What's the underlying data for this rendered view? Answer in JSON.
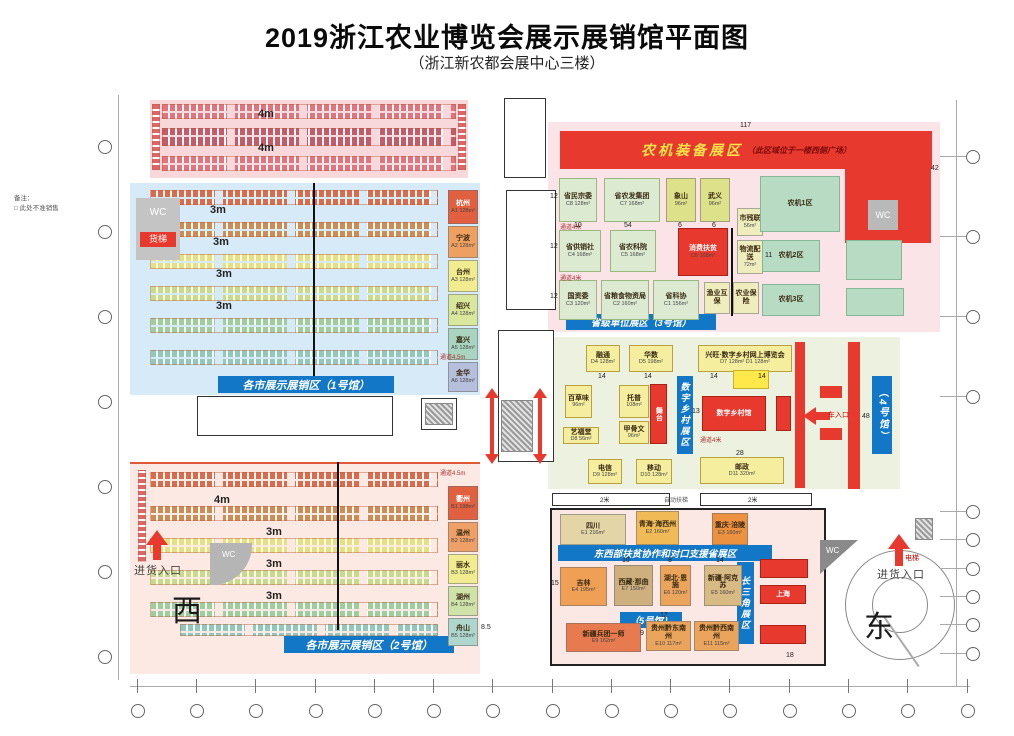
{
  "title": "2019浙江农业博览会展示展销馆平面图",
  "subtitle": "（浙江新农都会展中心三楼）",
  "legend": {
    "label": "备注：",
    "text": "□ 此处不准销售"
  },
  "compass": {
    "west": "西",
    "east": "东"
  },
  "entrances": {
    "west": "进货入口",
    "east": "进货入口",
    "vehicle": "车入口",
    "elevator": "电梯"
  },
  "facilities": {
    "wc": "WC",
    "freight_elevator": "货梯"
  },
  "banners": {
    "hall1": "各市展示展销区（1号馆）",
    "hall2": "各市展示展销区（2号馆）",
    "hall3": "省级单位展区（3号馆）",
    "hall4": "（4号馆）",
    "hall5": "（5号馆）",
    "east_west": "东西部扶贫协作和对口支援省展区",
    "digital": "数字乡村展区",
    "delta": "长三角展区",
    "machinery": "农机装备展区",
    "machinery_note": "（此区域位于一楼西侧广场）"
  },
  "blocks": [
    {
      "name": "杭州",
      "code": "A1 128m²",
      "style": {
        "left": "448px",
        "top": "190px",
        "width": "30px",
        "height": "34px",
        "background": "#e0603f",
        "color": "#fff"
      }
    },
    {
      "name": "宁波",
      "code": "A2 128m²",
      "style": {
        "left": "448px",
        "top": "226px",
        "width": "30px",
        "height": "32px",
        "background": "#eda05f"
      }
    },
    {
      "name": "台州",
      "code": "A3 128m²",
      "style": {
        "left": "448px",
        "top": "260px",
        "width": "30px",
        "height": "32px",
        "background": "#f0ec8f"
      }
    },
    {
      "name": "绍兴",
      "code": "A4 128m²",
      "style": {
        "left": "448px",
        "top": "294px",
        "width": "30px",
        "height": "32px",
        "background": "#d9e79c"
      }
    },
    {
      "name": "嘉兴",
      "code": "A5 128m²",
      "style": {
        "left": "448px",
        "top": "328px",
        "width": "30px",
        "height": "32px",
        "background": "#a8d4c0"
      }
    },
    {
      "name": "金华",
      "code": "A6 128m²",
      "style": {
        "left": "448px",
        "top": "362px",
        "width": "30px",
        "height": "30px",
        "background": "#b6bfdb"
      }
    },
    {
      "name": "衢州",
      "code": "B1 198m²",
      "style": {
        "left": "448px",
        "top": "486px",
        "width": "30px",
        "height": "34px",
        "background": "#e0603f",
        "color": "#fff"
      }
    },
    {
      "name": "温州",
      "code": "B2 128m²",
      "style": {
        "left": "448px",
        "top": "522px",
        "width": "30px",
        "height": "30px",
        "background": "#efa066"
      }
    },
    {
      "name": "丽水",
      "code": "B3 128m²",
      "style": {
        "left": "448px",
        "top": "554px",
        "width": "30px",
        "height": "30px",
        "background": "#f0ec8f"
      }
    },
    {
      "name": "湖州",
      "code": "B4 128m²",
      "style": {
        "left": "448px",
        "top": "586px",
        "width": "30px",
        "height": "30px",
        "background": "#cfe3a8"
      }
    },
    {
      "name": "舟山",
      "code": "B5 128m²",
      "style": {
        "left": "448px",
        "top": "618px",
        "width": "30px",
        "height": "28px",
        "background": "#aed6cd"
      }
    },
    {
      "name": "省民宗委",
      "code": "C8 128m²",
      "style": {
        "left": "559px",
        "top": "178px",
        "width": "38px",
        "height": "44px",
        "background": "#dcead2",
        "borderColor": "#9ab87e"
      }
    },
    {
      "name": "省农发集团",
      "code": "C7 168m²",
      "style": {
        "left": "604px",
        "top": "178px",
        "width": "56px",
        "height": "44px",
        "background": "#dcead2",
        "borderColor": "#9ab87e"
      }
    },
    {
      "name": "象山",
      "code": "96m²",
      "style": {
        "left": "666px",
        "top": "178px",
        "width": "30px",
        "height": "44px",
        "background": "#dde28a"
      }
    },
    {
      "name": "武义",
      "code": "96m²",
      "style": {
        "left": "700px",
        "top": "178px",
        "width": "30px",
        "height": "44px",
        "background": "#dde28a"
      }
    },
    {
      "name": "省供销社",
      "code": "C4 168m²",
      "style": {
        "left": "559px",
        "top": "230px",
        "width": "42px",
        "height": "42px",
        "background": "#dcead2",
        "borderColor": "#9ab87e"
      }
    },
    {
      "name": "省农科院",
      "code": "C5 168m²",
      "style": {
        "left": "610px",
        "top": "230px",
        "width": "46px",
        "height": "42px",
        "background": "#dcead2",
        "borderColor": "#9ab87e"
      }
    },
    {
      "name": "消费扶贫",
      "code": "C6 168m²",
      "style": {
        "left": "678px",
        "top": "228px",
        "width": "50px",
        "height": "48px",
        "background": "#e8392e",
        "color": "#fff",
        "borderColor": "#a82218"
      }
    },
    {
      "name": "市残联",
      "code": "56m²",
      "style": {
        "left": "737px",
        "top": "208px",
        "width": "26px",
        "height": "28px",
        "background": "#efedbe"
      }
    },
    {
      "name": "物流配送",
      "code": "72m²",
      "style": {
        "left": "737px",
        "top": "240px",
        "width": "26px",
        "height": "34px",
        "background": "#efedbe"
      }
    },
    {
      "name": "国资委",
      "code": "C3 120m²",
      "style": {
        "left": "559px",
        "top": "280px",
        "width": "38px",
        "height": "40px",
        "background": "#dcead2",
        "borderColor": "#9ab87e"
      }
    },
    {
      "name": "省粮食物资局",
      "code": "C2 160m²",
      "style": {
        "left": "601px",
        "top": "280px",
        "width": "48px",
        "height": "40px",
        "background": "#dcead2",
        "borderColor": "#9ab87e"
      }
    },
    {
      "name": "省科协",
      "code": "C1 156m²",
      "style": {
        "left": "653px",
        "top": "280px",
        "width": "46px",
        "height": "40px",
        "background": "#dcead2",
        "borderColor": "#9ab87e"
      }
    },
    {
      "name": "渔业互保",
      "code": "",
      "style": {
        "left": "704px",
        "top": "282px",
        "width": "26px",
        "height": "32px",
        "background": "#efedbe"
      }
    },
    {
      "name": "农业保险",
      "code": "",
      "style": {
        "left": "733px",
        "top": "282px",
        "width": "26px",
        "height": "32px",
        "background": "#efedbe"
      }
    },
    {
      "name": "农机1区",
      "code": "",
      "style": {
        "left": "760px",
        "top": "176px",
        "width": "80px",
        "height": "56px",
        "background": "#b8dbc4",
        "borderColor": "#86b796"
      }
    },
    {
      "name": "农机2区",
      "code": "",
      "style": {
        "left": "762px",
        "top": "240px",
        "width": "58px",
        "height": "32px",
        "background": "#b8dbc4",
        "borderColor": "#86b796"
      }
    },
    {
      "name": "农机3区",
      "code": "",
      "style": {
        "left": "762px",
        "top": "284px",
        "width": "58px",
        "height": "32px",
        "background": "#b8dbc4",
        "borderColor": "#86b796"
      }
    },
    {
      "name": "",
      "code": "",
      "style": {
        "left": "846px",
        "top": "240px",
        "width": "56px",
        "height": "40px",
        "background": "#b8dbc4",
        "borderColor": "#86b796"
      }
    },
    {
      "name": "",
      "code": "",
      "style": {
        "left": "846px",
        "top": "288px",
        "width": "58px",
        "height": "28px",
        "background": "#b8dbc4",
        "borderColor": "#86b796"
      }
    },
    {
      "name": "融通",
      "code": "D4 128m²",
      "style": {
        "left": "586px",
        "top": "345px",
        "width": "34px",
        "height": "27px",
        "background": "#f5ee9e",
        "borderColor": "#b9a13e"
      }
    },
    {
      "name": "华数",
      "code": "D5 198m²",
      "style": {
        "left": "629px",
        "top": "345px",
        "width": "44px",
        "height": "27px",
        "background": "#f5ee9e",
        "borderColor": "#b9a13e"
      }
    },
    {
      "name": "兴旺·数字乡村网上博览会",
      "code": "D7 128m²  D1 128m²",
      "style": {
        "left": "698px",
        "top": "345px",
        "width": "94px",
        "height": "27px",
        "background": "#f5ee9e",
        "borderColor": "#b9a13e"
      }
    },
    {
      "name": "百草味",
      "code": "96m²",
      "style": {
        "left": "565px",
        "top": "385px",
        "width": "27px",
        "height": "33px",
        "background": "#f5ee9e",
        "borderColor": "#b9a13e"
      }
    },
    {
      "name": "托普",
      "code": "108m²",
      "style": {
        "left": "619px",
        "top": "385px",
        "width": "30px",
        "height": "33px",
        "background": "#f5ee9e",
        "borderColor": "#b9a13e"
      }
    },
    {
      "name": "甲骨文",
      "code": "96m²",
      "style": {
        "left": "619px",
        "top": "421px",
        "width": "30px",
        "height": "23px",
        "background": "#f5ee9e",
        "borderColor": "#b9a13e"
      }
    },
    {
      "name": "艺福堂",
      "code": "D8 56m²",
      "style": {
        "left": "563px",
        "top": "427px",
        "width": "36px",
        "height": "17px",
        "background": "#f5ee9e",
        "borderColor": "#b9a13e"
      }
    },
    {
      "name": "舞台",
      "code": "",
      "style": {
        "left": "650px",
        "top": "384px",
        "width": "17px",
        "height": "60px",
        "background": "#e8392e",
        "color": "#fff",
        "writingMode": "vertical-lr",
        "borderColor": "#a82218"
      }
    },
    {
      "name": "数字乡村馆",
      "code": "",
      "style": {
        "left": "702px",
        "top": "396px",
        "width": "64px",
        "height": "35px",
        "background": "#e8392e",
        "color": "#fff",
        "borderColor": "#a82218"
      }
    },
    {
      "name": "",
      "code": "",
      "style": {
        "left": "776px",
        "top": "396px",
        "width": "15px",
        "height": "35px",
        "background": "#e8392e",
        "borderColor": "#a82218"
      }
    },
    {
      "name": "",
      "code": "",
      "style": {
        "left": "733px",
        "top": "370px",
        "width": "36px",
        "height": "19px",
        "background": "#ffe84a",
        "borderColor": "#c9b12e"
      }
    },
    {
      "name": "电信",
      "code": "D9 128m²",
      "style": {
        "left": "588px",
        "top": "459px",
        "width": "34px",
        "height": "25px",
        "background": "#f5ee9e",
        "borderColor": "#b9a13e"
      }
    },
    {
      "name": "移动",
      "code": "D10 128m²",
      "style": {
        "left": "636px",
        "top": "459px",
        "width": "36px",
        "height": "25px",
        "background": "#f5ee9e",
        "borderColor": "#b9a13e"
      }
    },
    {
      "name": "邮政",
      "code": "D11 320m²",
      "style": {
        "left": "700px",
        "top": "457px",
        "width": "84px",
        "height": "27px",
        "background": "#f5ee9e",
        "borderColor": "#b9a13e"
      }
    },
    {
      "name": "四川",
      "code": "E1 216m²",
      "style": {
        "left": "560px",
        "top": "514px",
        "width": "66px",
        "height": "31px",
        "background": "#e3d5a5"
      }
    },
    {
      "name": "青海·海西州",
      "code": "E2 160m²",
      "style": {
        "left": "636px",
        "top": "511px",
        "width": "43px",
        "height": "34px",
        "background": "#f0ba57"
      }
    },
    {
      "name": "重庆·涪陵",
      "code": "E3 160m²",
      "style": {
        "left": "712px",
        "top": "513px",
        "width": "36px",
        "height": "32px",
        "background": "#ec9140"
      }
    },
    {
      "name": "吉林",
      "code": "E4 195m²",
      "style": {
        "left": "560px",
        "top": "567px",
        "width": "47px",
        "height": "39px",
        "background": "#efa055"
      }
    },
    {
      "name": "西藏·那曲",
      "code": "E7 150m²",
      "style": {
        "left": "614px",
        "top": "565px",
        "width": "39px",
        "height": "41px",
        "background": "#cdb07e"
      }
    },
    {
      "name": "湖北·恩施",
      "code": "E6 120m²",
      "style": {
        "left": "660px",
        "top": "565px",
        "width": "31px",
        "height": "41px",
        "background": "#eaa45c"
      }
    },
    {
      "name": "新疆·阿克苏",
      "code": "E5 160m²",
      "style": {
        "left": "704px",
        "top": "565px",
        "width": "38px",
        "height": "41px",
        "background": "#d8ba84"
      }
    },
    {
      "name": "新疆兵团一师",
      "code": "E9 162m²",
      "style": {
        "left": "566px",
        "top": "623px",
        "width": "75px",
        "height": "29px",
        "background": "#e87a50"
      }
    },
    {
      "name": "贵州黔东南州",
      "code": "E10 117m²",
      "style": {
        "left": "646px",
        "top": "621px",
        "width": "45px",
        "height": "30px",
        "background": "#eaa45c"
      }
    },
    {
      "name": "贵州黔西南州",
      "code": "E11 115m²",
      "style": {
        "left": "694px",
        "top": "621px",
        "width": "45px",
        "height": "30px",
        "background": "#eaa45c"
      }
    },
    {
      "name": "",
      "code": "",
      "style": {
        "left": "760px",
        "top": "559px",
        "width": "48px",
        "height": "19px",
        "background": "#e8392e",
        "borderColor": "#a82218"
      }
    },
    {
      "name": "上海",
      "code": "",
      "style": {
        "left": "760px",
        "top": "585px",
        "width": "46px",
        "height": "19px",
        "background": "#e8392e",
        "color": "#fff",
        "borderColor": "#a82218"
      }
    },
    {
      "name": "",
      "code": "",
      "style": {
        "left": "760px",
        "top": "625px",
        "width": "46px",
        "height": "19px",
        "background": "#e8392e",
        "borderColor": "#a82218"
      }
    }
  ],
  "labels": [
    {
      "t": "4m",
      "style": {
        "left": "258px",
        "top": "108px",
        "fontSize": "11px",
        "fontWeight": "bold"
      }
    },
    {
      "t": "4m",
      "style": {
        "left": "258px",
        "top": "142px",
        "fontSize": "11px",
        "fontWeight": "bold"
      }
    },
    {
      "t": "3m",
      "style": {
        "left": "210px",
        "top": "204px",
        "fontSize": "11px",
        "fontWeight": "bold"
      }
    },
    {
      "t": "3m",
      "style": {
        "left": "213px",
        "top": "236px",
        "fontSize": "11px",
        "fontWeight": "bold"
      }
    },
    {
      "t": "3m",
      "style": {
        "left": "216px",
        "top": "268px",
        "fontSize": "11px",
        "fontWeight": "bold"
      }
    },
    {
      "t": "3m",
      "style": {
        "left": "216px",
        "top": "300px",
        "fontSize": "11px",
        "fontWeight": "bold"
      }
    },
    {
      "t": "4m",
      "style": {
        "left": "214px",
        "top": "494px",
        "fontSize": "11px",
        "fontWeight": "bold"
      }
    },
    {
      "t": "3m",
      "style": {
        "left": "266px",
        "top": "526px",
        "fontSize": "11px",
        "fontWeight": "bold"
      }
    },
    {
      "t": "3m",
      "style": {
        "left": "266px",
        "top": "558px",
        "fontSize": "11px",
        "fontWeight": "bold"
      }
    },
    {
      "t": "3m",
      "style": {
        "left": "266px",
        "top": "590px",
        "fontSize": "11px",
        "fontWeight": "bold"
      }
    },
    {
      "t": "通道4.5m",
      "style": {
        "left": "440px",
        "top": "352px",
        "fontSize": "6px",
        "color": "#a33"
      }
    },
    {
      "t": "通道4.5m",
      "style": {
        "left": "440px",
        "top": "468px",
        "fontSize": "6px",
        "color": "#a33"
      }
    },
    {
      "t": "通道4米",
      "style": {
        "left": "560px",
        "top": "222px",
        "fontSize": "6px",
        "color": "#a33"
      }
    },
    {
      "t": "通道4米",
      "style": {
        "left": "560px",
        "top": "273px",
        "fontSize": "6px",
        "color": "#a33"
      }
    },
    {
      "t": "通道4米",
      "style": {
        "left": "700px",
        "top": "435px",
        "fontSize": "6px",
        "color": "#a33"
      }
    },
    {
      "t": "自动扶梯",
      "style": {
        "left": "664px",
        "top": "495px",
        "fontSize": "6px",
        "color": "#555"
      }
    },
    {
      "t": "2米",
      "style": {
        "left": "600px",
        "top": "495px",
        "fontSize": "6px"
      }
    },
    {
      "t": "2米",
      "style": {
        "left": "748px",
        "top": "495px",
        "fontSize": "6px"
      }
    },
    {
      "t": "117",
      "style": {
        "left": "740px",
        "top": "122px"
      }
    },
    {
      "t": "42",
      "style": {
        "left": "931px",
        "top": "165px"
      }
    },
    {
      "t": "48",
      "style": {
        "left": "862px",
        "top": "413px"
      }
    },
    {
      "t": "18",
      "style": {
        "left": "786px",
        "top": "652px"
      }
    },
    {
      "t": "12",
      "style": {
        "left": "550px",
        "top": "193px"
      }
    },
    {
      "t": "12",
      "style": {
        "left": "550px",
        "top": "243px"
      }
    },
    {
      "t": "12",
      "style": {
        "left": "550px",
        "top": "293px"
      }
    },
    {
      "t": "10",
      "style": {
        "left": "574px",
        "top": "222px"
      }
    },
    {
      "t": "54",
      "style": {
        "left": "624px",
        "top": "222px"
      }
    },
    {
      "t": "6",
      "style": {
        "left": "678px",
        "top": "222px"
      }
    },
    {
      "t": "6",
      "style": {
        "left": "712px",
        "top": "222px"
      }
    },
    {
      "t": "11",
      "style": {
        "left": "765px",
        "top": "252px"
      }
    },
    {
      "t": "14",
      "style": {
        "left": "598px",
        "top": "373px"
      }
    },
    {
      "t": "14",
      "style": {
        "left": "644px",
        "top": "373px"
      }
    },
    {
      "t": "14",
      "style": {
        "left": "710px",
        "top": "373px"
      }
    },
    {
      "t": "14",
      "style": {
        "left": "758px",
        "top": "373px"
      }
    },
    {
      "t": "13",
      "style": {
        "left": "692px",
        "top": "408px"
      }
    },
    {
      "t": "28",
      "style": {
        "left": "736px",
        "top": "450px"
      }
    },
    {
      "t": "15",
      "style": {
        "left": "551px",
        "top": "580px"
      }
    },
    {
      "t": "10",
      "style": {
        "left": "622px",
        "top": "557px"
      }
    },
    {
      "t": "8",
      "style": {
        "left": "668px",
        "top": "557px"
      }
    },
    {
      "t": "14",
      "style": {
        "left": "716px",
        "top": "557px"
      }
    },
    {
      "t": "12",
      "style": {
        "left": "660px",
        "top": "612px"
      }
    },
    {
      "t": "9",
      "style": {
        "left": "640px",
        "top": "630px"
      }
    },
    {
      "t": "8.5",
      "style": {
        "left": "481px",
        "top": "624px"
      }
    }
  ]
}
